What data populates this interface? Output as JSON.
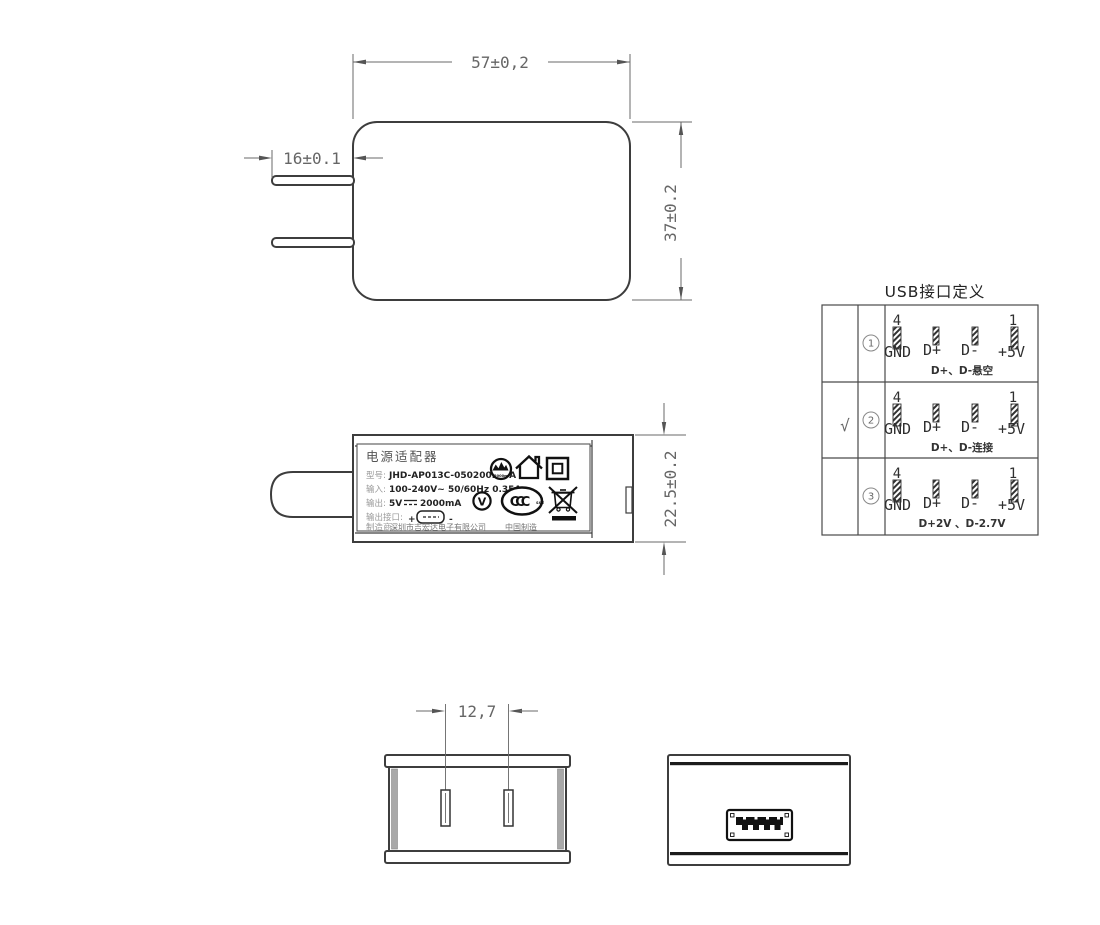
{
  "top_view": {
    "dim_width": "57±0,2",
    "dim_prong": "16±0.1",
    "dim_height": "37±0.2"
  },
  "side_view": {
    "dim_height": "22.5±0.2",
    "label": {
      "title": "电源适配器",
      "model_key": "型号:",
      "model_value": "JHD-AP013C-050200BB-A",
      "input_key": "输入:",
      "input_value": "100-240V~ 50/60Hz 0.35A",
      "output_key": "输出:",
      "output_voltage": "5V",
      "output_current": "2000mA",
      "port_key": "输出接口:",
      "port_plus": "+",
      "port_minus": "-",
      "mfr_key": "制造商:",
      "mfr_value": "深圳市吉宏达电子有限公司",
      "made_in": "中国制造",
      "altitude_caption": "2000m",
      "v_mark": "V",
      "ccc_text": "CCC",
      "ccc_small": "S&E"
    }
  },
  "usb_table": {
    "title": "USB接口定义",
    "pin_top_left": "4",
    "pin_top_right": "1",
    "pin_labels": [
      "GND",
      "D+",
      "D-",
      "+5V"
    ],
    "rows": [
      {
        "check": "",
        "num": "1",
        "note": "D+、D-悬空"
      },
      {
        "check": "√",
        "num": "2",
        "note": "D+、D-连接"
      },
      {
        "check": "",
        "num": "3",
        "note": "D+2V 、D-2.7V"
      }
    ]
  },
  "bottom_views": {
    "dim_pin_spacing": "12,7"
  }
}
